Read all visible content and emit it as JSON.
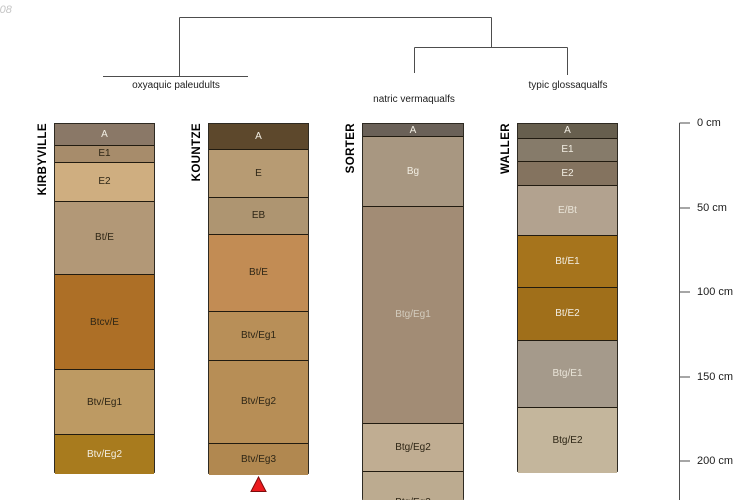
{
  "annotation": "-08",
  "classification_tree": {
    "groups": [
      {
        "label": "oxyaquic paleudults",
        "members": [
          "KIRBYVILLE",
          "KOUNTZE"
        ],
        "label_x": 176,
        "label_y": 80
      },
      {
        "label": "natric vermaqualfs",
        "members": [
          "SORTER"
        ],
        "label_x": 414,
        "label_y": 94
      },
      {
        "label": "typic glossaqualfs",
        "members": [
          "WALLER"
        ],
        "label_x": 568,
        "label_y": 80
      }
    ]
  },
  "depth_scale": {
    "unit": "cm",
    "axis_x": 679,
    "ticks": [
      {
        "label": "0 cm",
        "depth_cm": 0,
        "y": 123
      },
      {
        "label": "50 cm",
        "depth_cm": 50,
        "y": 208
      },
      {
        "label": "100 cm",
        "depth_cm": 100,
        "y": 292
      },
      {
        "label": "150 cm",
        "depth_cm": 150,
        "y": 377
      },
      {
        "label": "200 cm",
        "depth_cm": 200,
        "y": 461
      }
    ]
  },
  "columns": [
    {
      "id": "kirbyville",
      "name": "KIRBYVILLE",
      "group": "oxyaquic paleudults",
      "x": 54,
      "width": 101,
      "horizons": [
        {
          "label": "A",
          "top": 123,
          "bottom": 144.5,
          "top_cm": 0,
          "bottom_cm": 13,
          "color": "#8a7867",
          "text": "#f2eee3"
        },
        {
          "label": "E1",
          "top": 144.5,
          "bottom": 162,
          "top_cm": 13,
          "bottom_cm": 23,
          "color": "#a78c6b",
          "text": "#2e2616"
        },
        {
          "label": "E2",
          "top": 162,
          "bottom": 200.5,
          "top_cm": 23,
          "bottom_cm": 46,
          "color": "#cfae80",
          "text": "#2e2616"
        },
        {
          "label": "Bt/E",
          "top": 200.5,
          "bottom": 274,
          "top_cm": 46,
          "bottom_cm": 89,
          "color": "#b29877",
          "text": "#2e2616"
        },
        {
          "label": "Btcv/E",
          "top": 274,
          "bottom": 369,
          "top_cm": 89,
          "bottom_cm": 145,
          "color": "#ad6f26",
          "text": "#2e2616"
        },
        {
          "label": "Btv/Eg1",
          "top": 369,
          "bottom": 434,
          "top_cm": 145,
          "bottom_cm": 184,
          "color": "#bd9a63",
          "text": "#2e2616"
        },
        {
          "label": "Btv/Eg2",
          "top": 434,
          "bottom": 473,
          "top_cm": 184,
          "bottom_cm": 207,
          "color": "#a87b1e",
          "text": "#f2eee3"
        }
      ]
    },
    {
      "id": "kountze",
      "name": "KOUNTZE",
      "group": "oxyaquic paleudults",
      "x": 208,
      "width": 101,
      "horizons": [
        {
          "label": "A",
          "top": 123,
          "bottom": 148.5,
          "top_cm": 0,
          "bottom_cm": 15,
          "color": "#5d482c",
          "text": "#f2eee3"
        },
        {
          "label": "E",
          "top": 148.5,
          "bottom": 197,
          "top_cm": 15,
          "bottom_cm": 44,
          "color": "#b79b73",
          "text": "#2e2616"
        },
        {
          "label": "EB",
          "top": 197,
          "bottom": 233.5,
          "top_cm": 44,
          "bottom_cm": 65,
          "color": "#ae9571",
          "text": "#2e2616"
        },
        {
          "label": "Bt/E",
          "top": 233.5,
          "bottom": 311,
          "top_cm": 65,
          "bottom_cm": 111,
          "color": "#c28c54",
          "text": "#2e2616"
        },
        {
          "label": "Btv/Eg1",
          "top": 311,
          "bottom": 359.5,
          "top_cm": 111,
          "bottom_cm": 140,
          "color": "#b88f58",
          "text": "#2e2616"
        },
        {
          "label": "Btv/Eg2",
          "top": 359.5,
          "bottom": 442.5,
          "top_cm": 140,
          "bottom_cm": 189,
          "color": "#b78e56",
          "text": "#2e2616"
        },
        {
          "label": "Btv/Eg3",
          "top": 442.5,
          "bottom": 474,
          "top_cm": 189,
          "bottom_cm": 207,
          "color": "#b18850",
          "text": "#2e2616"
        }
      ]
    },
    {
      "id": "sorter",
      "name": "SORTER",
      "group": "natric vermaqualfs",
      "x": 362,
      "width": 102,
      "horizons": [
        {
          "label": "A",
          "top": 123,
          "bottom": 136,
          "top_cm": 0,
          "bottom_cm": 8,
          "color": "#6a6158",
          "text": "#f2eee3"
        },
        {
          "label": "Bg",
          "top": 136,
          "bottom": 206,
          "top_cm": 8,
          "bottom_cm": 49,
          "color": "#a89781",
          "text": "#f2eee3"
        },
        {
          "label": "Btg/Eg1",
          "top": 206,
          "bottom": 422.5,
          "top_cm": 49,
          "bottom_cm": 177,
          "color": "#a28c75",
          "text": "#d3ccbe"
        },
        {
          "label": "Btg/Eg2",
          "top": 422.5,
          "bottom": 471,
          "top_cm": 177,
          "bottom_cm": 205,
          "color": "#c0ad92",
          "text": "#2e2616"
        },
        {
          "label": "Btg/Eg3",
          "top": 471,
          "bottom": 500,
          "top_cm": 205,
          "bottom_cm": 222,
          "color": "#bcab90",
          "text": "#2e2616",
          "label_top": 25,
          "clipped": true
        }
      ]
    },
    {
      "id": "waller",
      "name": "WALLER",
      "group": "typic glossaqualfs",
      "x": 517,
      "width": 101,
      "horizons": [
        {
          "label": "A",
          "top": 123,
          "bottom": 137.5,
          "top_cm": 0,
          "bottom_cm": 9,
          "color": "#675f4e",
          "text": "#f2eee3"
        },
        {
          "label": "E1",
          "top": 137.5,
          "bottom": 160.5,
          "top_cm": 9,
          "bottom_cm": 22,
          "color": "#867b6a",
          "text": "#f2eee3"
        },
        {
          "label": "E2",
          "top": 160.5,
          "bottom": 185,
          "top_cm": 22,
          "bottom_cm": 37,
          "color": "#84735f",
          "text": "#f2eee3"
        },
        {
          "label": "E/Bt",
          "top": 185,
          "bottom": 235,
          "top_cm": 37,
          "bottom_cm": 66,
          "color": "#b2a28f",
          "text": "#e9e4d8"
        },
        {
          "label": "Bt/E1",
          "top": 235,
          "bottom": 286.5,
          "top_cm": 66,
          "bottom_cm": 97,
          "color": "#a6741c",
          "text": "#f2eee3"
        },
        {
          "label": "Bt/E2",
          "top": 286.5,
          "bottom": 339.5,
          "top_cm": 97,
          "bottom_cm": 128,
          "color": "#a06f1a",
          "text": "#f2eee3"
        },
        {
          "label": "Btg/E1",
          "top": 339.5,
          "bottom": 407,
          "top_cm": 128,
          "bottom_cm": 168,
          "color": "#a59a8b",
          "text": "#e9e4d8"
        },
        {
          "label": "Btg/E2",
          "top": 407,
          "bottom": 471.5,
          "top_cm": 168,
          "bottom_cm": 206,
          "color": "#c4b69c",
          "text": "#2e2616"
        }
      ]
    }
  ],
  "marker": {
    "shape": "triangle-up",
    "column": "KOUNTZE",
    "color": "#ec1b1f",
    "outline": "#7d0c0c",
    "x": 258.5,
    "y_top": 477,
    "y_bottom": 491.5,
    "half_width": 7.5
  }
}
